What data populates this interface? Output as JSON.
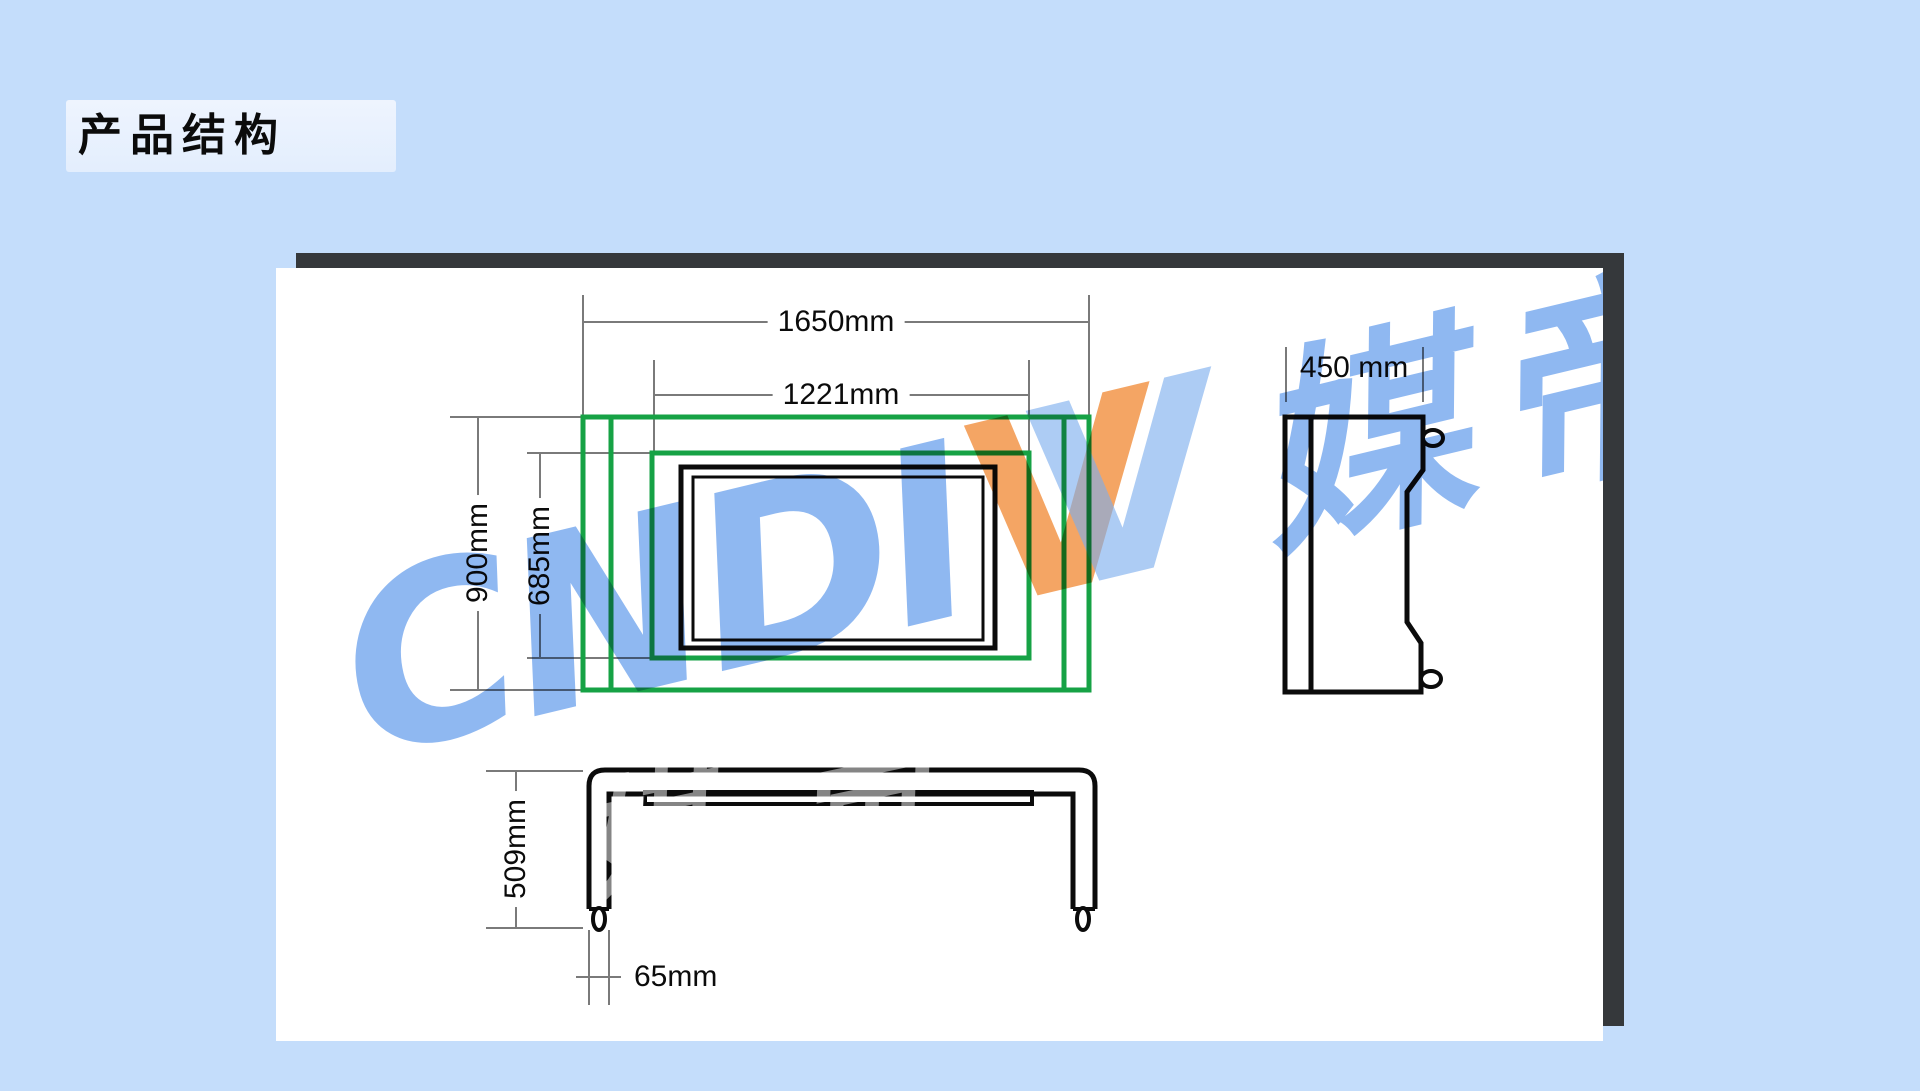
{
  "header": {
    "title": "产品结构"
  },
  "canvas": {
    "front_view": {
      "outer_width": "1650mm",
      "inner_width": "1221mm",
      "outer_height": "900mm",
      "inner_height": "685mm"
    },
    "side_view": {
      "depth": "450 mm"
    },
    "bottom_view": {
      "stand_height": "509mm",
      "foot_offset": "65mm"
    }
  },
  "watermark": {
    "latin_cnd": "CND",
    "latin_i": "I",
    "latin_v_orange": "V",
    "latin_v_blue": "V",
    "cjk": "媒帝",
    "ghost_text": "媒帝"
  },
  "colors": {
    "page_background": "#C4DDFB",
    "canvas_background": "#FFFFFF",
    "canvas_shadow": "#35383B",
    "outline_green": "#16A245",
    "drawing_black": "#0B0B0B",
    "dimension_gray": "#7A7A7A",
    "watermark_blue": "#8FBBEE",
    "watermark_orange": "#F5A96E"
  }
}
